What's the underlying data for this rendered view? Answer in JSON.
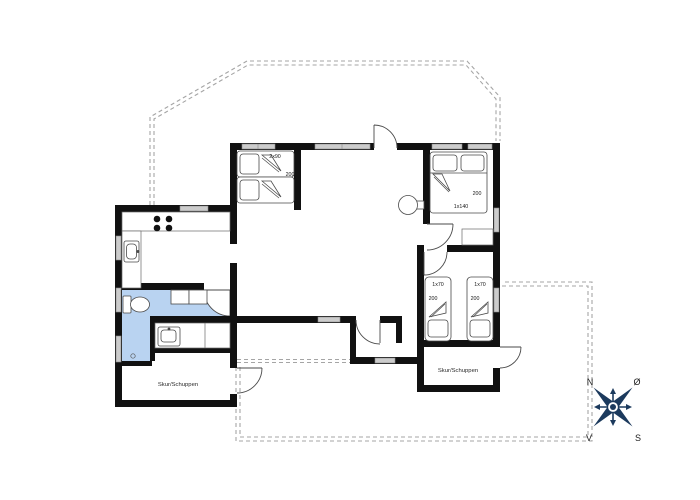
{
  "floorplan": {
    "labels": {
      "bed_tl_size": "2x90",
      "bed_tl_len": "200",
      "bed_tr_len": "200",
      "bed_tr_size": "1x140",
      "bed_r1_size": "1x70",
      "bed_r1_len": "200",
      "bed_r2_size": "1x70",
      "bed_r2_len": "200",
      "shed_left": "Skur/Schuppen",
      "shed_right": "Skur/Schuppen"
    },
    "compass": {
      "n": "N",
      "e": "Ø",
      "s": "S",
      "w": "V"
    },
    "colors": {
      "wall": "#111111",
      "window_fill": "#cccccc",
      "bathroom_fill": "#b9d3f1",
      "boundary_dash": "#a5a5a5",
      "compass_navy": "#1c3a5d"
    }
  }
}
